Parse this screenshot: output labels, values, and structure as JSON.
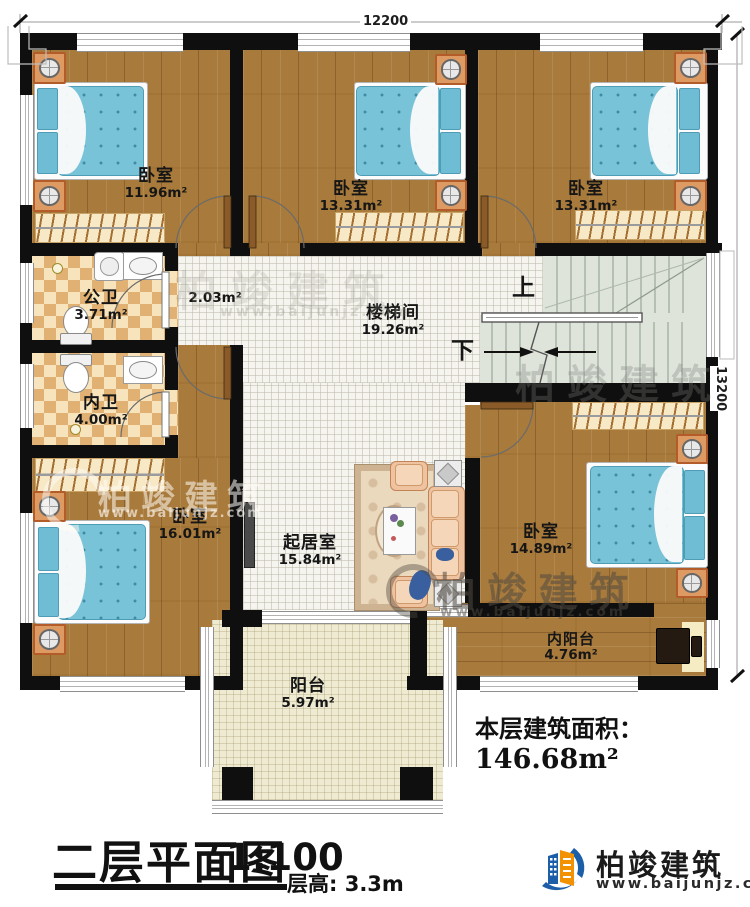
{
  "meta": {
    "plan_title": "二层平面图",
    "plan_scale": "1:100",
    "floor_height": "层高: 3.3m",
    "total_area_label": "本层建筑面积：",
    "total_area_value": "146.68m²"
  },
  "dimensions": {
    "width_top": "12200",
    "height_right": "13200"
  },
  "stairs": {
    "up_label": "上",
    "down_label": "下"
  },
  "rooms": [
    {
      "id": "bedroom-top-left",
      "name": "卧室",
      "area": "11.96m²"
    },
    {
      "id": "bedroom-top-middle",
      "name": "卧室",
      "area": "13.31m²"
    },
    {
      "id": "bedroom-top-right",
      "name": "卧室",
      "area": "13.31m²"
    },
    {
      "id": "public-bathroom",
      "name": "公卫",
      "area": "3.71m²"
    },
    {
      "id": "corridor",
      "name": "",
      "area": "2.03m²"
    },
    {
      "id": "stairwell",
      "name": "楼梯间",
      "area": "19.26m²"
    },
    {
      "id": "private-bathroom",
      "name": "内卫",
      "area": "4.00m²"
    },
    {
      "id": "bedroom-bottom-left",
      "name": "卧室",
      "area": "16.01m²"
    },
    {
      "id": "living-room",
      "name": "起居室",
      "area": "15.84m²"
    },
    {
      "id": "bedroom-bottom-right",
      "name": "卧室",
      "area": "14.89m²"
    },
    {
      "id": "inner-balcony",
      "name": "内阳台",
      "area": "4.76m²"
    },
    {
      "id": "balcony",
      "name": "阳台",
      "area": "5.97m²"
    }
  ],
  "brand": {
    "name": "柏竣建筑",
    "url": "www.baijunjz.com"
  },
  "colors": {
    "wall": "#0f0f0f",
    "wood_floor": "#a87a3b",
    "bed": "#79c3d9",
    "stair": "#dee4da",
    "balcony": "#efead2",
    "brand_blue": "#1c5fa8",
    "brand_orange": "#f29200"
  }
}
